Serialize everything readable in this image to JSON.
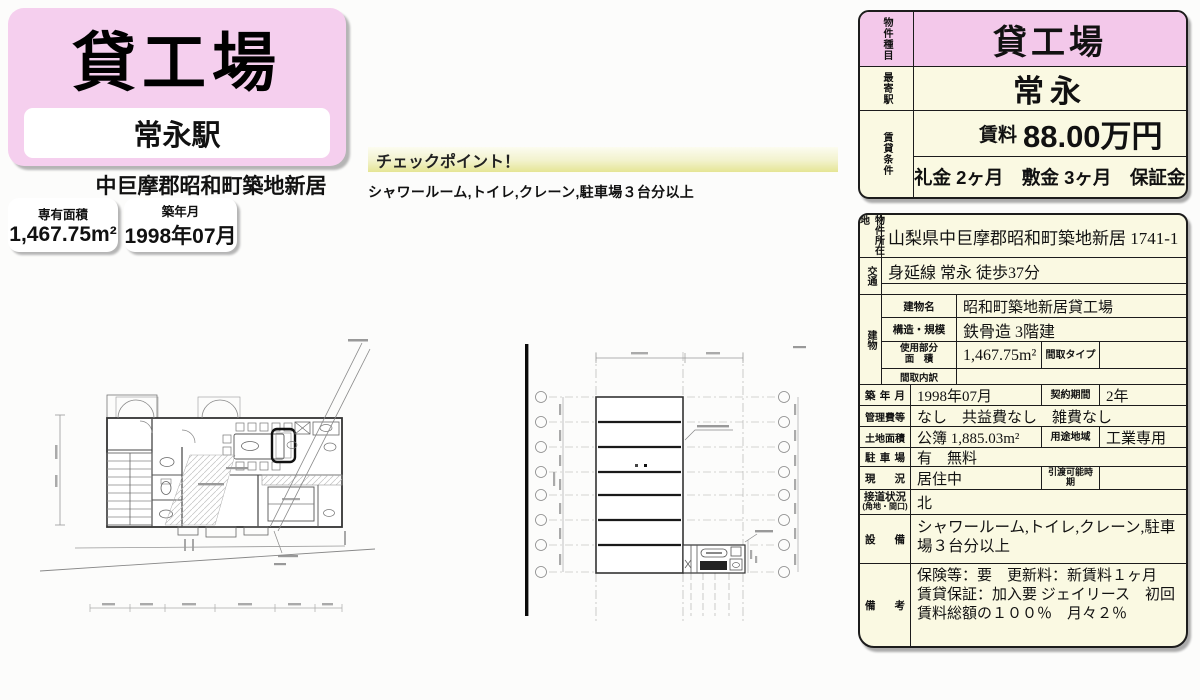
{
  "colors": {
    "pink": "#f3c8ea",
    "card_pink": "#f5cfee",
    "cream": "#faf9e2",
    "checkpoint_yellow": "#e5e595"
  },
  "header": {
    "title": "貸工場",
    "station": "常永駅",
    "address": "中巨摩郡昭和町築地新居",
    "area": {
      "label": "専有面積",
      "value": "1,467.75m²"
    },
    "built": {
      "label": "築年月",
      "value": "1998年07月"
    }
  },
  "checkpoint": {
    "title": "チェックポイント！",
    "text": "シャワールーム,トイレ,クレーン,駐車場３台分以上"
  },
  "summary": {
    "property_type": {
      "label": "物件種目",
      "value": "貸工場"
    },
    "station": {
      "label": "最寄駅",
      "value": "常永"
    },
    "terms": {
      "label": "賃貸条件",
      "rent_label": "賃料",
      "rent_value": "88.00万円",
      "deposits": "礼金 2ヶ月　敷金 3ヶ月　保証金 なし"
    }
  },
  "details": {
    "location": {
      "label": "物件所在地",
      "value": "山梨県中巨摩郡昭和町築地新居 1741-1"
    },
    "access": {
      "label": "交通",
      "value": "身延線 常永 徒歩37分"
    },
    "building": {
      "label": "建物",
      "name": {
        "label": "建物名",
        "value": "昭和町築地新居貸工場"
      },
      "structure": {
        "label": "構造・規模",
        "value": "鉄骨造 3階建"
      },
      "floor_area": {
        "label_line1": "使用部分",
        "label_line2": "面　積",
        "value": "1,467.75m²",
        "type_label": "間取タイプ",
        "type_value": ""
      },
      "layout": {
        "label": "間取内訳",
        "value": ""
      }
    },
    "built": {
      "label": "築年月",
      "value": "1998年07月",
      "label2": "契約期間",
      "value2": "2年"
    },
    "fees": {
      "label": "管理費等",
      "value": "なし　共益費なし　雑費なし"
    },
    "land": {
      "label": "土地面積",
      "value": "公簿 1,885.03m²",
      "label2": "用途地域",
      "value2": "工業専用"
    },
    "parking": {
      "label": "駐車場",
      "value": "有　無料"
    },
    "status": {
      "label": "現　況",
      "value": "居住中",
      "label2": "引渡可能時期",
      "value2": ""
    },
    "road": {
      "label": "接道状況",
      "label_sub": "(角地・間口)",
      "value": "北"
    },
    "equipment": {
      "label": "設　備",
      "value": "シャワールーム,トイレ,クレーン,駐車場３台分以上"
    },
    "notes": {
      "label": "備　考",
      "value": "保険等：要　更新料：新賃料１ヶ月　賃貸保証：加入要 ジェイリース　初回賃料総額の１００％　月々２％"
    }
  }
}
